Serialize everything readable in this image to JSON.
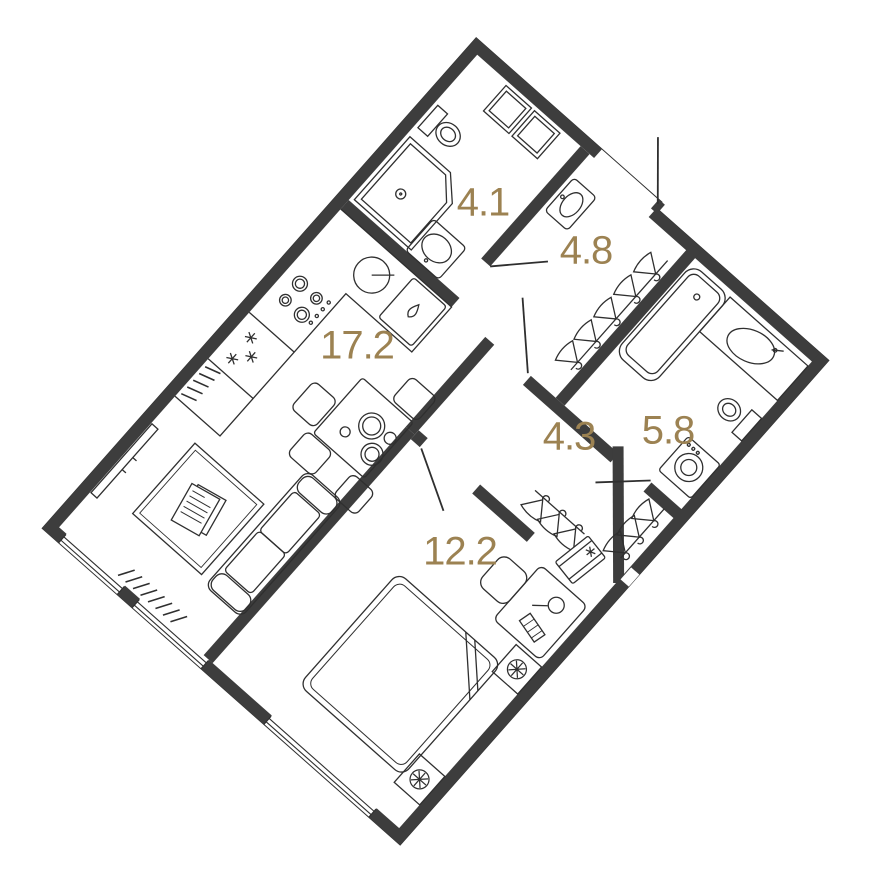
{
  "plan": {
    "title": "apartment-floor-plan",
    "rotation_deg": 41.5,
    "wall_color": "#3d3d3d",
    "line_color": "#2f2f2f",
    "label_color": "#9c8252",
    "background": "#ffffff",
    "rooms": [
      {
        "id": "bathroom-1",
        "area_label": "4.1",
        "label_pos": {
          "x": 483,
          "y": 203
        },
        "furniture": [
          "shower-cabin",
          "toilet",
          "washer-shelf-niche",
          "sink"
        ]
      },
      {
        "id": "entry-hall",
        "area_label": "4.8",
        "label_pos": {
          "x": 586,
          "y": 251
        },
        "furniture": [
          "wall-sink",
          "coat-hangers",
          "entrance-door"
        ]
      },
      {
        "id": "kitchen-living",
        "area_label": "17.2",
        "label_pos": {
          "x": 357,
          "y": 346
        },
        "furniture": [
          "kitchen-counter",
          "round-sink",
          "dishwasher",
          "hob",
          "fridge",
          "radiator",
          "dining-table",
          "chairs",
          "sofa",
          "tv",
          "carpet",
          "windows"
        ]
      },
      {
        "id": "corridor",
        "area_label": "4.3",
        "label_pos": {
          "x": 569,
          "y": 437
        },
        "furniture": [
          "wardrobe-hangers"
        ]
      },
      {
        "id": "bathroom-2",
        "area_label": "5.8",
        "label_pos": {
          "x": 668,
          "y": 431
        },
        "furniture": [
          "bathtub",
          "vanity-sink",
          "toilet",
          "washing-machine"
        ]
      },
      {
        "id": "bedroom",
        "area_label": "12.2",
        "label_pos": {
          "x": 460,
          "y": 552
        },
        "furniture": [
          "double-bed",
          "nightstand-lamps",
          "desk",
          "chair",
          "closet-hangers",
          "storage-box",
          "window"
        ]
      }
    ]
  }
}
